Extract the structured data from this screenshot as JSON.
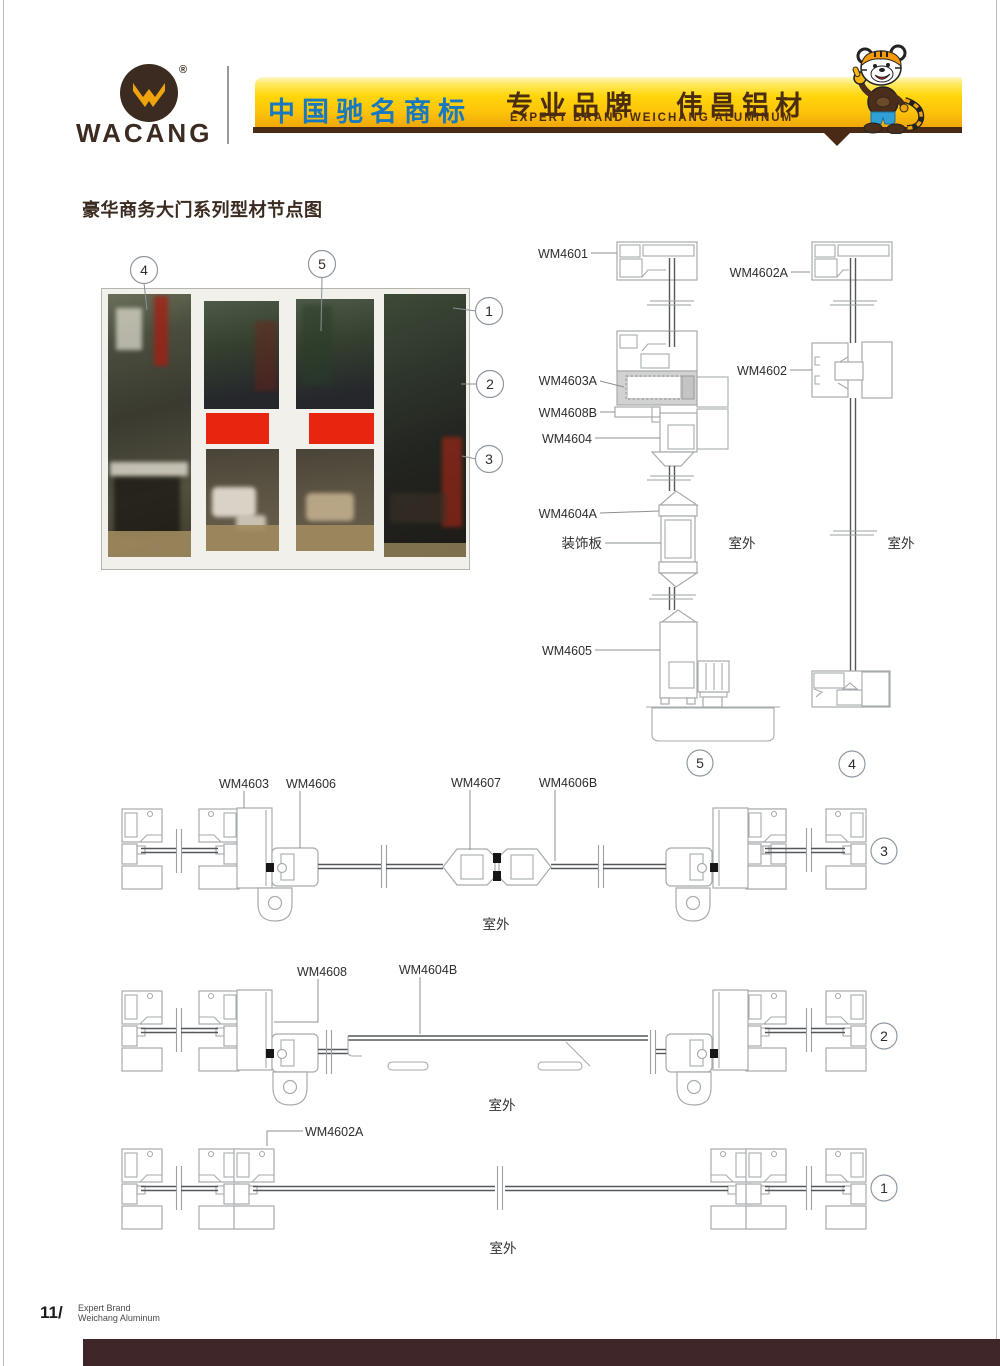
{
  "colors": {
    "accent_yellow": "#ffd60a",
    "brand_brown": "#3b2b21",
    "banner_blue": "#1879bf",
    "banner_text_brown": "#4a2c10",
    "footer_bar_brown": "#3f2629",
    "red_door_panel": "#e8250e",
    "profile_line_gray": "#a6abad"
  },
  "header": {
    "brand": "WACANG",
    "reg_mark": "®",
    "banner": {
      "cn_trademark": "中国驰名商标",
      "cn_slogan": "专业品牌",
      "cn_brand": "伟昌铝材",
      "en_line": "EXPERT BRAND WEICHANG ALUMINUM"
    }
  },
  "title": "豪华商务大门系列型材节点图",
  "photo": {
    "callout_1": "1",
    "callout_2": "2",
    "callout_3": "3",
    "callout_4": "4",
    "callout_5": "5"
  },
  "vertical_sections": {
    "wm4601": "WM4601",
    "wm4602a": "WM4602A",
    "wm4603a": "WM4603A",
    "wm4602": "WM4602",
    "wm4608b": "WM4608B",
    "wm4604": "WM4604",
    "wm4604a": "WM4604A",
    "decor_panel": "装饰板",
    "wm4605": "WM4605",
    "outdoor_left": "室外",
    "outdoor_right": "室外",
    "section_5": "5",
    "section_4": "4"
  },
  "section_3": {
    "wm4603": "WM4603",
    "wm4606": "WM4606",
    "wm4607": "WM4607",
    "wm4606b": "WM4606B",
    "outdoor": "室外",
    "num": "3"
  },
  "section_2": {
    "wm4608": "WM4608",
    "wm4604b": "WM4604B",
    "outdoor": "室外",
    "num": "2"
  },
  "section_1": {
    "wm4602a": "WM4602A",
    "outdoor": "室外",
    "num": "1"
  },
  "footer": {
    "page_no": "11/",
    "line1": "Expert Brand",
    "line2": "Weichang Aluminum"
  }
}
